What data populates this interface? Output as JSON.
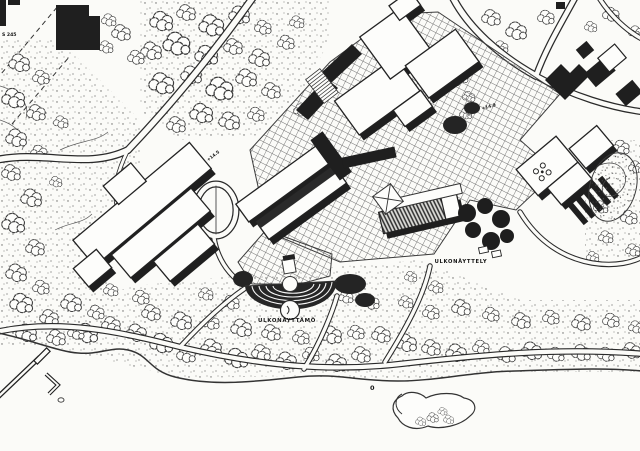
{
  "map": {
    "description": "Scanned black-and-white architectural site plan of a waterfront exhibition campus",
    "labels": {
      "amphitheater": "ULKONÄYTTÄMÖ",
      "outdoor_exhibition": "ULKONÄYTTELY",
      "elevation_left": "+14.5",
      "elevation_right": "+14.9",
      "edge_note": "S 245",
      "depth_mark": "0"
    },
    "colors": {
      "paper": "#fbfbf8",
      "ink": "#1f1f1f",
      "hatch_line": "#6f6f6f",
      "tree_stroke": "#3b3b3b"
    }
  }
}
